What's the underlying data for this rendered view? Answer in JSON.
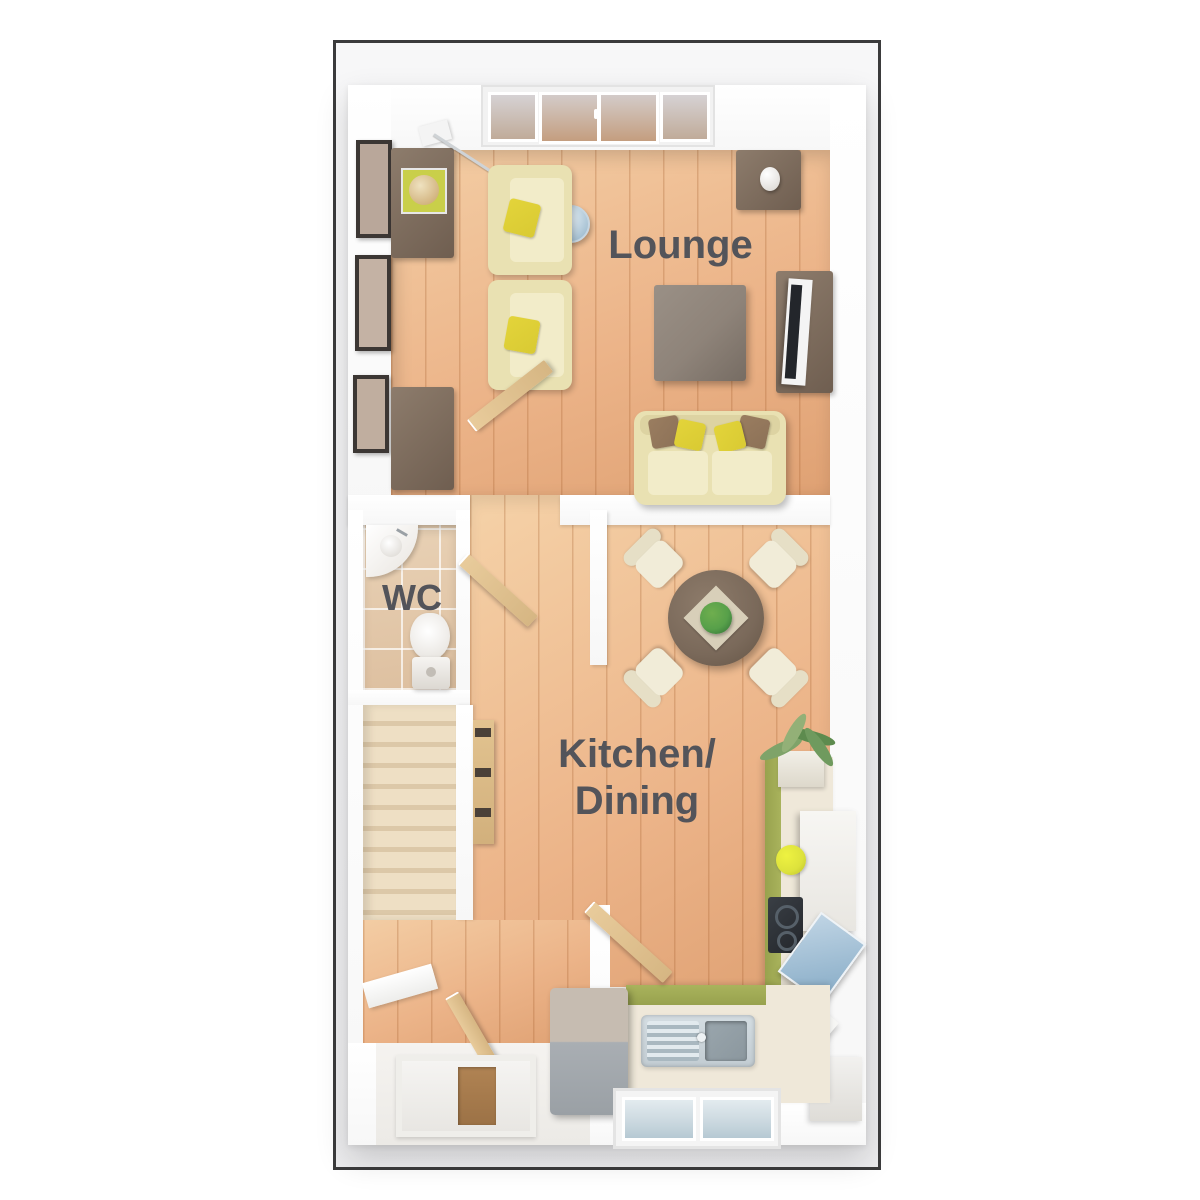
{
  "labels": {
    "lounge": "Lounge",
    "wc": "WC",
    "kitchen_line1": "Kitchen/",
    "kitchen_line2": "Dining"
  },
  "rooms": [
    "Lounge",
    "WC",
    "Kitchen/Dining"
  ],
  "colors": {
    "frame_border": "#3b3b3c",
    "label": "#53545a",
    "wood_light": "#f3cda4",
    "wood_mid": "#ecb489",
    "wood_dark": "#dfa173",
    "kitchen_wood_light": "#f5d2a8",
    "plank_line": "rgba(164,94,44,0.28)",
    "tile": "#ddbf9f",
    "tile_light": "#e9d2b6",
    "grout": "rgba(255,255,255,0.7)",
    "carpet_light": "#eedfc4",
    "carpet_dark": "#dcc8a8",
    "furniture_dark": "#8d7c6c",
    "furniture_dark2": "#6f5e50",
    "coffee_table": "#8e8379",
    "table_wood": "#7a695a",
    "sofa_cream": "#e9e1b2",
    "seat_cream": "#f2ecc9",
    "chair_cream": "#f1ecd8",
    "cushion_yellow": "#d9ca33",
    "cushion_brown": "#8c7157",
    "fridge": "#a9aeb3",
    "fridge_top": "#c6bcb1",
    "steel": "#c2ccd2",
    "steel_dark": "#8b979e",
    "counter": "#efe8d9",
    "cabinet_green": "#a9b35c",
    "plant_dark": "#2e6b33",
    "plant_mid": "#57a04a",
    "palm_green": "#7fa369",
    "lemon": "#dde23c",
    "glass": "#d6d2d4",
    "glass_blue": "#ccd9e0",
    "door_wood": "#e8cb9b",
    "mat_brown": "#9c7246",
    "tv_dark": "#23262b"
  }
}
